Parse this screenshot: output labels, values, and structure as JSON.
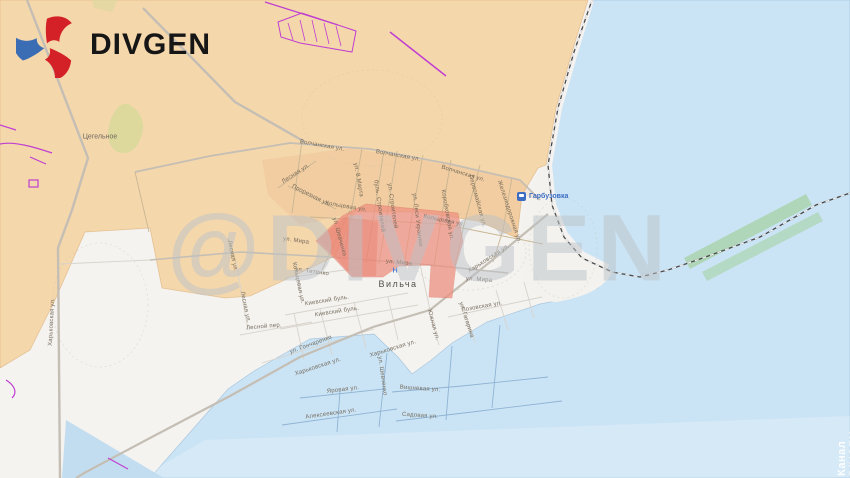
{
  "branding": {
    "logo_text": "DIVGEN",
    "watermark_text": "@DIVGEN",
    "channel_watermark": "Канал DIVGEN | @divgen"
  },
  "colors": {
    "controlled_area": "#f5d7ac",
    "advance_area": "#ee9181",
    "water": "#cbe4f5",
    "vegetation": "#d8d99a",
    "fortification_line": "#bf3fd0",
    "logo_red": "#d42027",
    "logo_blue": "#3b6db5",
    "street_label": "#6e6354",
    "station_label": "#3d6dc3"
  },
  "map": {
    "places": [
      {
        "name": "Цегельное",
        "x": 100,
        "y": 137
      },
      {
        "name": "Вильча",
        "x": 398,
        "y": 284
      },
      {
        "name": "Гарбузовка",
        "x": 531,
        "y": 197,
        "type": "station"
      }
    ],
    "icons": [
      {
        "name": "station-icon",
        "x": 517,
        "y": 192
      },
      {
        "name": "hospital-icon",
        "glyph": "Н",
        "x": 395,
        "y": 271
      }
    ],
    "streets": [
      {
        "label": "Волчанская ул.",
        "x": 322,
        "y": 146,
        "r": 10
      },
      {
        "label": "Волчанская ул.",
        "x": 398,
        "y": 156,
        "r": 10
      },
      {
        "label": "Волчанская ул.",
        "x": 463,
        "y": 174,
        "r": 17
      },
      {
        "label": "Лесная ул.",
        "x": 296,
        "y": 174,
        "r": -33
      },
      {
        "label": "Прорезная ул.",
        "x": 311,
        "y": 196,
        "r": 27
      },
      {
        "label": "ул. 8 Марта",
        "x": 358,
        "y": 180,
        "r": 80
      },
      {
        "label": "Кольцевая ул.",
        "x": 346,
        "y": 207,
        "r": 10
      },
      {
        "label": "Кольцевая ул.",
        "x": 444,
        "y": 221,
        "r": 12
      },
      {
        "label": "Кольцевая ул.",
        "x": 298,
        "y": 283,
        "r": 78
      },
      {
        "label": "буль. Строителей",
        "x": 379,
        "y": 206,
        "r": 82
      },
      {
        "label": "ул. Строителей",
        "x": 392,
        "y": 206,
        "r": 82
      },
      {
        "label": "ул. Леси Украинки",
        "x": 417,
        "y": 220,
        "r": 83
      },
      {
        "label": "Коробковская ул.",
        "x": 447,
        "y": 215,
        "r": 80
      },
      {
        "label": "Первомайская ул.",
        "x": 477,
        "y": 201,
        "r": 75
      },
      {
        "label": "Железнодорожная ул.",
        "x": 509,
        "y": 212,
        "r": 72
      },
      {
        "label": "ул. Шевченко",
        "x": 339,
        "y": 237,
        "r": 75
      },
      {
        "label": "ул. Шевченко",
        "x": 382,
        "y": 376,
        "r": 82
      },
      {
        "label": "ул. Мира",
        "x": 296,
        "y": 241,
        "r": 8
      },
      {
        "label": "ул. Мира",
        "x": 399,
        "y": 263,
        "r": 6
      },
      {
        "label": "ул. Мира",
        "x": 479,
        "y": 280,
        "r": 4
      },
      {
        "label": "ул. Титенко",
        "x": 312,
        "y": 272,
        "r": 8
      },
      {
        "label": "Харьковская ул.",
        "x": 489,
        "y": 259,
        "r": -33
      },
      {
        "label": "Харьковская ул.",
        "x": 393,
        "y": 349,
        "r": -17
      },
      {
        "label": "Харьковская ул.",
        "x": 318,
        "y": 367,
        "r": -18
      },
      {
        "label": "Харьковская ул.",
        "x": 52,
        "y": 322,
        "r": -87
      },
      {
        "label": "Киевский буль.",
        "x": 327,
        "y": 301,
        "r": -9
      },
      {
        "label": "Киевский буль.",
        "x": 337,
        "y": 312,
        "r": -9
      },
      {
        "label": "Лесной пер.",
        "x": 264,
        "y": 327,
        "r": -5
      },
      {
        "label": "ул. Гончаренко",
        "x": 311,
        "y": 345,
        "r": -20
      },
      {
        "label": "Яровая ул.",
        "x": 343,
        "y": 390,
        "r": -7
      },
      {
        "label": "Вишневая ул.",
        "x": 420,
        "y": 389,
        "r": 4
      },
      {
        "label": "Садовая ул.",
        "x": 420,
        "y": 416,
        "r": 4
      },
      {
        "label": "Алексеевская ул.",
        "x": 331,
        "y": 414,
        "r": -8
      },
      {
        "label": "ул. Гагарина",
        "x": 466,
        "y": 320,
        "r": 72
      },
      {
        "label": "Южная ул.",
        "x": 433,
        "y": 325,
        "r": 75
      },
      {
        "label": "Лозовская ул.",
        "x": 482,
        "y": 307,
        "r": -10
      },
      {
        "label": "Лесная ул.",
        "x": 232,
        "y": 256,
        "r": 78
      },
      {
        "label": "Лесная ул.",
        "x": 245,
        "y": 307,
        "r": 78
      }
    ]
  }
}
